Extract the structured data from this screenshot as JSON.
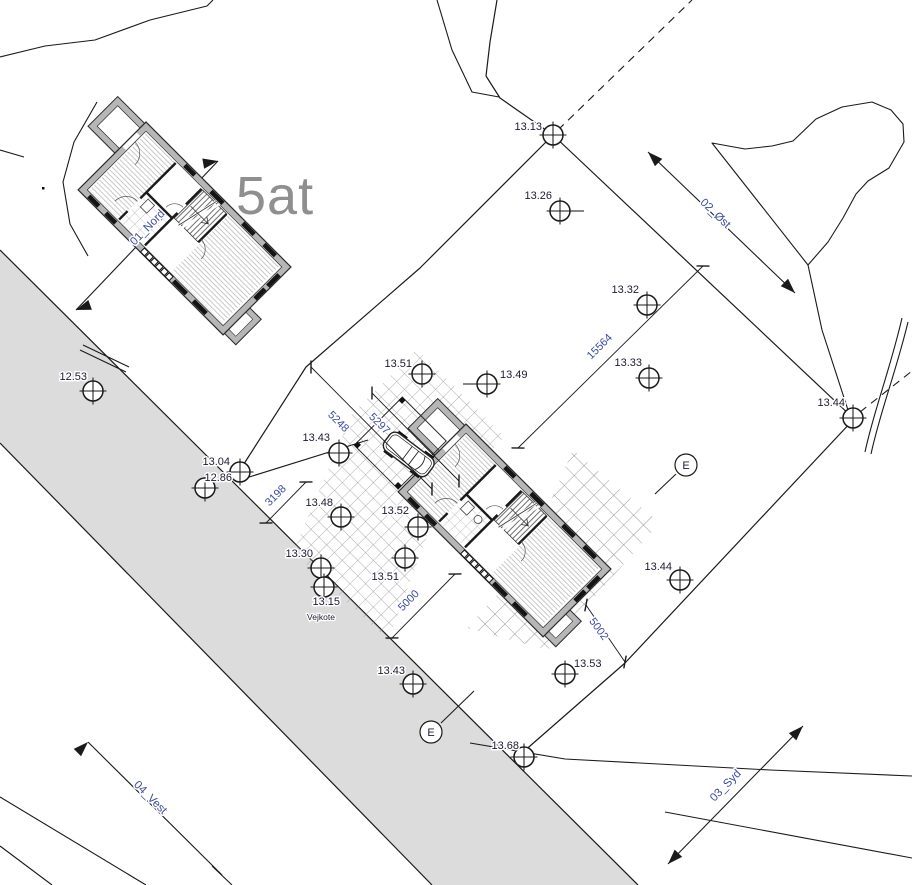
{
  "labels": {
    "plot": "5at",
    "vejkote": "Vejkote"
  },
  "colors": {
    "road": "#dcdcdc",
    "wall": "#b6b6b6",
    "ink": "#1a1a1a",
    "dim_text": "#3b4aa0",
    "elev_text": "#1c1c30",
    "plot_label": "#8f8f8f"
  },
  "markers": [
    {
      "value": "13.13",
      "cx": 553,
      "cy": 135,
      "tx": 542,
      "ty": 130,
      "anchor": "end"
    },
    {
      "value": "13.26",
      "cx": 560,
      "cy": 211,
      "tx": 552,
      "ty": 199,
      "anchor": "end",
      "tick": [
        571,
        211,
        584,
        211
      ]
    },
    {
      "value": "13.32",
      "cx": 647,
      "cy": 305,
      "tx": 639,
      "ty": 293,
      "anchor": "end"
    },
    {
      "value": "13.33",
      "cx": 649,
      "cy": 378,
      "tx": 642,
      "ty": 366,
      "anchor": "end"
    },
    {
      "value": "13.44",
      "cx": 853,
      "cy": 418,
      "tx": 845,
      "ty": 406,
      "anchor": "end"
    },
    {
      "value": "12.53",
      "cx": 93,
      "cy": 391,
      "tx": 87,
      "ty": 380,
      "anchor": "end"
    },
    {
      "value": "13.04",
      "cx": 240,
      "cy": 472,
      "tx": 230,
      "ty": 465,
      "anchor": "end"
    },
    {
      "value": "12.86",
      "cx": 205,
      "cy": 488,
      "tx": 232,
      "ty": 481,
      "anchor": "end"
    },
    {
      "value": "13.43",
      "cx": 339,
      "cy": 453,
      "tx": 330,
      "ty": 441,
      "anchor": "end"
    },
    {
      "value": "13.51",
      "cx": 422,
      "cy": 374,
      "tx": 412,
      "ty": 367,
      "anchor": "end"
    },
    {
      "value": "13.49",
      "cx": 487,
      "cy": 384,
      "tx": 500,
      "ty": 378,
      "anchor": "start",
      "tick": [
        463,
        384,
        475,
        384
      ]
    },
    {
      "value": "13.48",
      "cx": 341,
      "cy": 517,
      "tx": 333,
      "ty": 506,
      "anchor": "end"
    },
    {
      "value": "13.52",
      "cx": 418,
      "cy": 527,
      "tx": 409,
      "ty": 514,
      "anchor": "end"
    },
    {
      "value": "13.30",
      "cx": 321,
      "cy": 568,
      "tx": 313,
      "ty": 557,
      "anchor": "end"
    },
    {
      "value": "13.51",
      "cx": 405,
      "cy": 558,
      "tx": 399,
      "ty": 580,
      "anchor": "end"
    },
    {
      "value": "13.15",
      "cx": 324,
      "cy": 587,
      "tx": 340,
      "ty": 605,
      "anchor": "end"
    },
    {
      "value": "13.43",
      "cx": 413,
      "cy": 684,
      "tx": 405,
      "ty": 674,
      "anchor": "end"
    },
    {
      "value": "13.53",
      "cx": 565,
      "cy": 674,
      "tx": 574,
      "ty": 667,
      "anchor": "start"
    },
    {
      "value": "13.68",
      "cx": 524,
      "cy": 757,
      "tx": 519,
      "ty": 749,
      "anchor": "end"
    },
    {
      "value": "13.44",
      "cx": 680,
      "cy": 580,
      "tx": 672,
      "ty": 570,
      "anchor": "end"
    }
  ],
  "dimensions": [
    {
      "value": "15564",
      "x1": 703,
      "y1": 266,
      "x2": 518,
      "y2": 448,
      "tx": 602,
      "ty": 349,
      "rot": -45
    },
    {
      "value": "5248",
      "x1": 311,
      "y1": 367,
      "x2": 432,
      "y2": 489,
      "tx": 336,
      "ty": 424,
      "rot": 45
    },
    {
      "value": "5297",
      "x1": 372,
      "y1": 393,
      "x2": 459,
      "y2": 481,
      "tx": 377,
      "ty": 426,
      "rot": 45
    },
    {
      "value": "3198",
      "x1": 306,
      "y1": 482,
      "x2": 266,
      "y2": 523,
      "tx": 278,
      "ty": 498,
      "rot": -45
    },
    {
      "value": "5000",
      "x1": 455,
      "y1": 574,
      "x2": 392,
      "y2": 638,
      "tx": 411,
      "ty": 603,
      "rot": -45
    },
    {
      "value": "5002",
      "x1": 586,
      "y1": 605,
      "x2": 625,
      "y2": 662,
      "tx": 596,
      "ty": 631,
      "rot": 54
    }
  ],
  "sections": [
    {
      "label": "01_Nord",
      "x1": 76,
      "y1": 310,
      "x2": 218,
      "y2": 161,
      "tx": 150,
      "ty": 230,
      "rot": -46,
      "arrows": [
        {
          "x": 218,
          "y": 161,
          "angle": 350
        },
        {
          "x": 76,
          "y": 310,
          "angle": 160
        }
      ]
    },
    {
      "label": "02_Øst",
      "x1": 648,
      "y1": 152,
      "x2": 795,
      "y2": 293,
      "tx": 713,
      "ty": 216,
      "rot": 44,
      "arrows": [
        {
          "x": 648,
          "y": 152,
          "angle": 225
        },
        {
          "x": 795,
          "y": 293,
          "angle": 45
        }
      ]
    },
    {
      "label": "03_Syd",
      "x1": 668,
      "y1": 864,
      "x2": 803,
      "y2": 726,
      "tx": 728,
      "ty": 788,
      "rot": -46,
      "arrows": [
        {
          "x": 668,
          "y": 864,
          "angle": 134
        },
        {
          "x": 803,
          "y": 726,
          "angle": 314
        }
      ]
    },
    {
      "label": "04_Vest",
      "x1": 88,
      "y1": 742,
      "x2": 222,
      "y2": 875,
      "tx": 148,
      "ty": 800,
      "rot": 45,
      "arrows": [
        {
          "x": 88,
          "y": 742,
          "angle": 315
        }
      ]
    }
  ],
  "e_markers": [
    {
      "label": "E",
      "cx": 686,
      "cy": 465,
      "leader": [
        676,
        474,
        655,
        494
      ]
    },
    {
      "label": "E",
      "cx": 431,
      "cy": 732,
      "leader": [
        441,
        723,
        474,
        691
      ]
    }
  ]
}
